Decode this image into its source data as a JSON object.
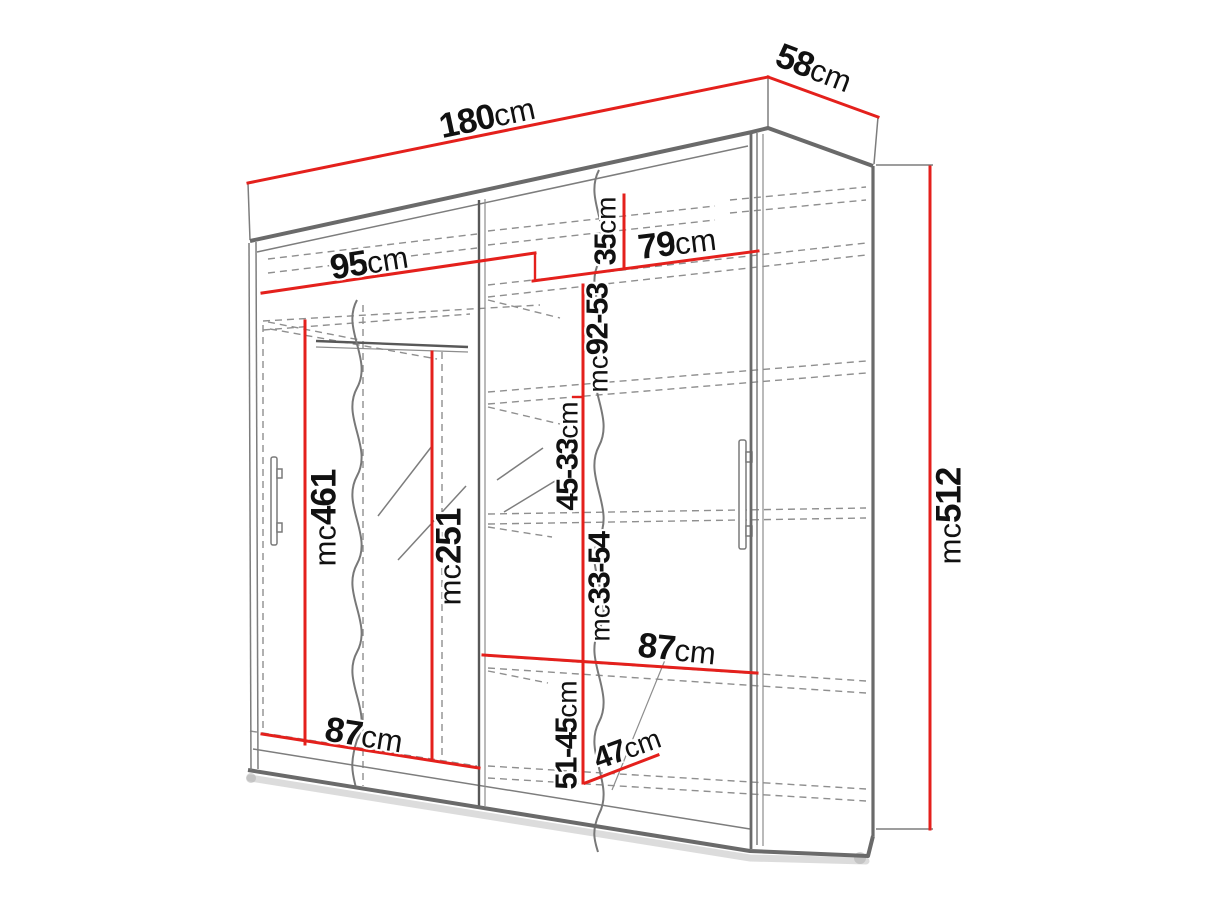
{
  "diagram": {
    "unit": "cm",
    "colors": {
      "dimension_red": "#e4201c",
      "outline_gray": "#6a6a6a",
      "hidden_line_gray": "#8f8f8f",
      "text_black": "#111111",
      "background": "#ffffff"
    },
    "dimensions": {
      "overall_width": {
        "value": "180",
        "unit": "cm"
      },
      "overall_depth": {
        "value": "58",
        "unit": "cm"
      },
      "overall_height": {
        "value": "215",
        "unit": "cm"
      },
      "left_section_width": {
        "value": "95",
        "unit": "cm"
      },
      "right_section_width": {
        "value": "79",
        "unit": "cm"
      },
      "top_shelf_spacing": {
        "value": "35",
        "unit": "cm"
      },
      "second_shelf_spacing": {
        "value": "35-29",
        "unit": "cm"
      },
      "middle_shelf_spacing": {
        "value": "45-33",
        "unit": "cm"
      },
      "lower_shelf_spacing": {
        "value": "45-33",
        "unit": "cm"
      },
      "bottom_section_height": {
        "value": "51-45",
        "unit": "cm"
      },
      "bottom_section_depth": {
        "value": "47",
        "unit": "cm"
      },
      "right_shelf_width": {
        "value": "87",
        "unit": "cm"
      },
      "left_bottom_width": {
        "value": "87",
        "unit": "cm"
      },
      "left_hanging_height": {
        "value": "164",
        "unit": "cm"
      },
      "mirror_strip_height": {
        "value": "152",
        "unit": "cm"
      }
    }
  }
}
